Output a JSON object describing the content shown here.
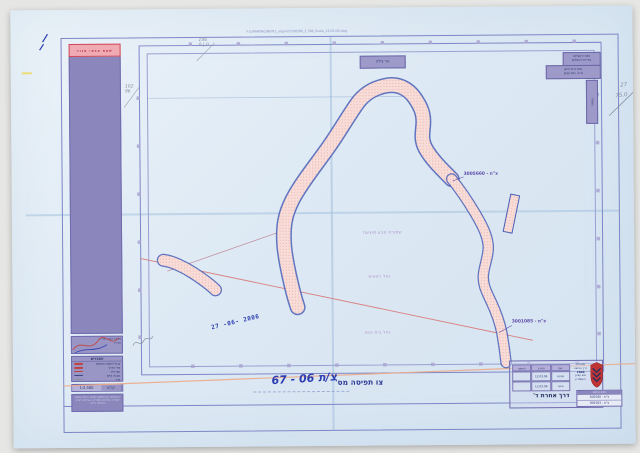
{
  "colors": {
    "paper_blue": "#dde9f4",
    "frame_blue": "#7d87c6",
    "strip_purple": "#8b87bd",
    "label_purple": "#9d99c8",
    "corridor_pink": "#f8dcd8",
    "corridor_outline": "#4a60b6",
    "red_line": "#d97f7f",
    "orange_line": "#edaa88",
    "handwriting_blue": "#2b3db0",
    "emblem_red": "#c13434"
  },
  "scan": {
    "header_filename": "F:\\DRAWING\\NEW1_aligned\\300580_2,500_Scale_12.03.06.dwg"
  },
  "sidebar": {
    "warning": "שטח צבאי סגור",
    "signature_box": {
      "line1": "מפקד כוחות צה\"ל",
      "line2": "תאריך"
    },
    "legend": {
      "title": "הסברים",
      "rows": [
        {
          "label": "גבול השטח התפוס",
          "color": "#c24040"
        },
        {
          "label": "ציר הדרך",
          "color": "#c24040"
        },
        {
          "label": "עצי זית",
          "color": "#c24040"
        },
        {
          "label": "מבנה קיים",
          "color": "#3a4680"
        },
        {
          "label": "גדר",
          "color": "#8a92a2"
        }
      ],
      "scale_label": "קנ\"מ",
      "scale_value": "1:2,500",
      "notes": "ההעתקה או השימוש במפה זו ללא אישור אסורה. המידות במטרים. הגבולות לצרכי המחשה בלבד."
    }
  },
  "map": {
    "top_box_label": "הר גילה",
    "region_boxes": [
      {
        "line1": "נפת ירושלים",
        "line2": "עיריית ירושלים"
      },
      {
        "line1": "נפת בית לחם",
        "line2": "מ.א. גוש עציון"
      }
    ],
    "side_tab": "מפתח",
    "road_label_top": "צ\"ת - 3005660",
    "road_label_bottom": "צ\"ת - 3001085",
    "area_labels": {
      "reserve": "שמורת טבע מוצעת",
      "stream1": "נחל רפאים",
      "stream2": "נחל בית הנם"
    },
    "date_stamp": "27 -06- 2006",
    "pencil_notes": {
      "top_left_top": "146",
      "top_left_bottom": "0 | 0",
      "left_top": "102",
      "left_bottom": "96",
      "right_top": "27",
      "right_bottom": "75.0"
    }
  },
  "title_block": {
    "label": "צו תפיסה מס'",
    "handwritten": "צ/ת 06 - 67"
  },
  "stamp_block": {
    "table_headers": [
      "חתימה",
      "תאריך",
      "שם"
    ],
    "table_rows": [
      [
        "",
        "12.03.06",
        "שרטט"
      ],
      [
        "",
        "12.03.06",
        "אישר"
      ]
    ],
    "org_lines": [
      "מנהלת",
      "דרך הגישה",
      "1600",
      "גוש עציון",
      "והשומרון"
    ],
    "unit": "דרך אחרת ד'",
    "refs_title": "צווים קיימים",
    "refs": [
      "צ\"ת - 300580",
      "צ\"ת - 300583"
    ]
  }
}
